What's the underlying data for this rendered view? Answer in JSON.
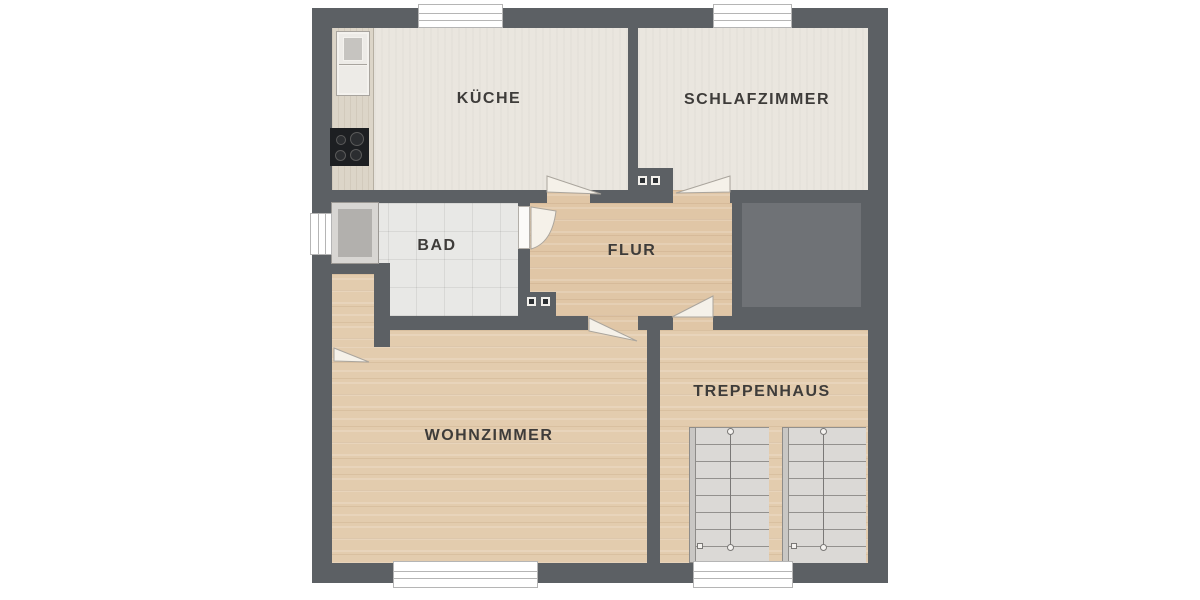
{
  "plan": {
    "type": "floor-plan",
    "language": "de",
    "rooms": [
      {
        "id": "kueche",
        "label": "KÜCHE"
      },
      {
        "id": "schlafzimmer",
        "label": "SCHLAFZIMMER"
      },
      {
        "id": "bad",
        "label": "BAD"
      },
      {
        "id": "flur",
        "label": "FLUR"
      },
      {
        "id": "wohnzimmer",
        "label": "WOHNZIMMER"
      },
      {
        "id": "treppenhaus",
        "label": "TREPPENHAUS"
      }
    ],
    "fixtures": [
      "kitchen-counter",
      "kitchen-sink",
      "cooktop",
      "shower",
      "stair-flight-left",
      "stair-flight-right",
      "chimney-upper",
      "chimney-lower"
    ],
    "openings": {
      "windows": [
        "kueche-top",
        "schlafzimmer-top",
        "bad-left",
        "wohnzimmer-bottom",
        "treppenhaus-bottom"
      ],
      "doors": [
        "kueche",
        "schlafzimmer",
        "bad",
        "wohnzimmer",
        "treppenhaus",
        "niche"
      ]
    },
    "colors": {
      "wall": "#5c6064",
      "void_fill": "#6f7276",
      "floor_cream": "#eae6df",
      "floor_wood": "#e3ccae",
      "floor_tile": "#e8e8e6",
      "stairs": "#dbd9d6",
      "window": "#ffffff",
      "label_text": "#3e3c3a"
    }
  }
}
